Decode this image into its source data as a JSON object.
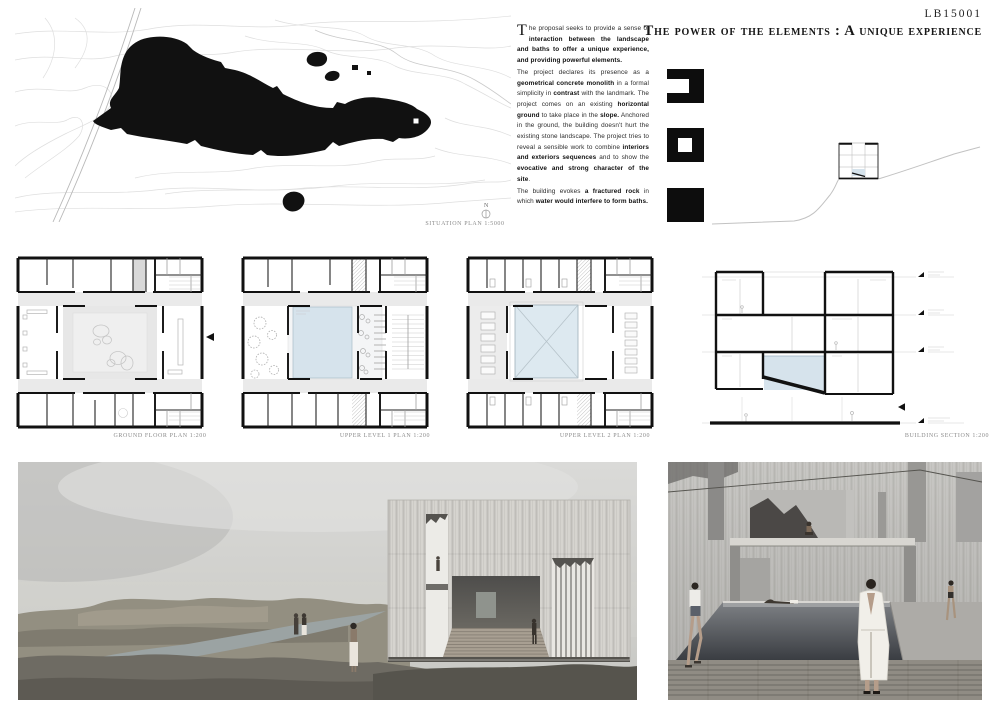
{
  "board": {
    "id": "LB15001",
    "title": "The power of the elements : A unique experience"
  },
  "intro": {
    "dropcap": "T",
    "paragraphs": [
      {
        "segments": [
          {
            "t": "he proposal seeks to provide a sense of ",
            "b": 0
          },
          {
            "t": "interaction between the landscape and baths to offer a unique experience, and providing powerful elements.",
            "b": 1
          }
        ]
      },
      {
        "segments": [
          {
            "t": "The project declares its presence as a ",
            "b": 0
          },
          {
            "t": "geometrical concrete monolith",
            "b": 1
          },
          {
            "t": " in a formal simplicity in ",
            "b": 0
          },
          {
            "t": "contrast",
            "b": 1
          },
          {
            "t": " with the landmark. The project comes on an existing ",
            "b": 0
          },
          {
            "t": "horizontal ground",
            "b": 1
          },
          {
            "t": " to take place in the ",
            "b": 0
          },
          {
            "t": "slope.",
            "b": 1
          },
          {
            "t": " Anchored in the ground, the building doesn't hurt the existing stone landscape. The project tries to reveal a sensible work to combine ",
            "b": 0
          },
          {
            "t": "interiors and exteriors sequences",
            "b": 1
          },
          {
            "t": " and to show the ",
            "b": 0
          },
          {
            "t": "evocative and strong character of the site",
            "b": 1
          },
          {
            "t": ".",
            "b": 0
          }
        ]
      },
      {
        "segments": [
          {
            "t": "The building evokes ",
            "b": 0
          },
          {
            "t": "a fractured rock",
            "b": 1
          },
          {
            "t": " in which ",
            "b": 0
          },
          {
            "t": "water would interfere to form baths.",
            "b": 1
          }
        ]
      }
    ]
  },
  "captions": {
    "situation_plan": "SITUATION PLAN 1:5000",
    "ground_floor": "GROUND FLOOR PLAN 1:200",
    "upper_level_1": "UPPER LEVEL 1 PLAN 1:200",
    "upper_level_2": "UPPER LEVEL 2 PLAN 1:200",
    "building_section": "BUILDING SECTION 1:200"
  },
  "map": {
    "north_label": "N"
  },
  "colors": {
    "pool_blue": "#d6e3ec",
    "void_blue": "#dde9f0",
    "plan_gray": "#eaeaea",
    "wall_black": "#111111",
    "caption_gray": "#8b8b8b",
    "paper": "#ffffff"
  }
}
